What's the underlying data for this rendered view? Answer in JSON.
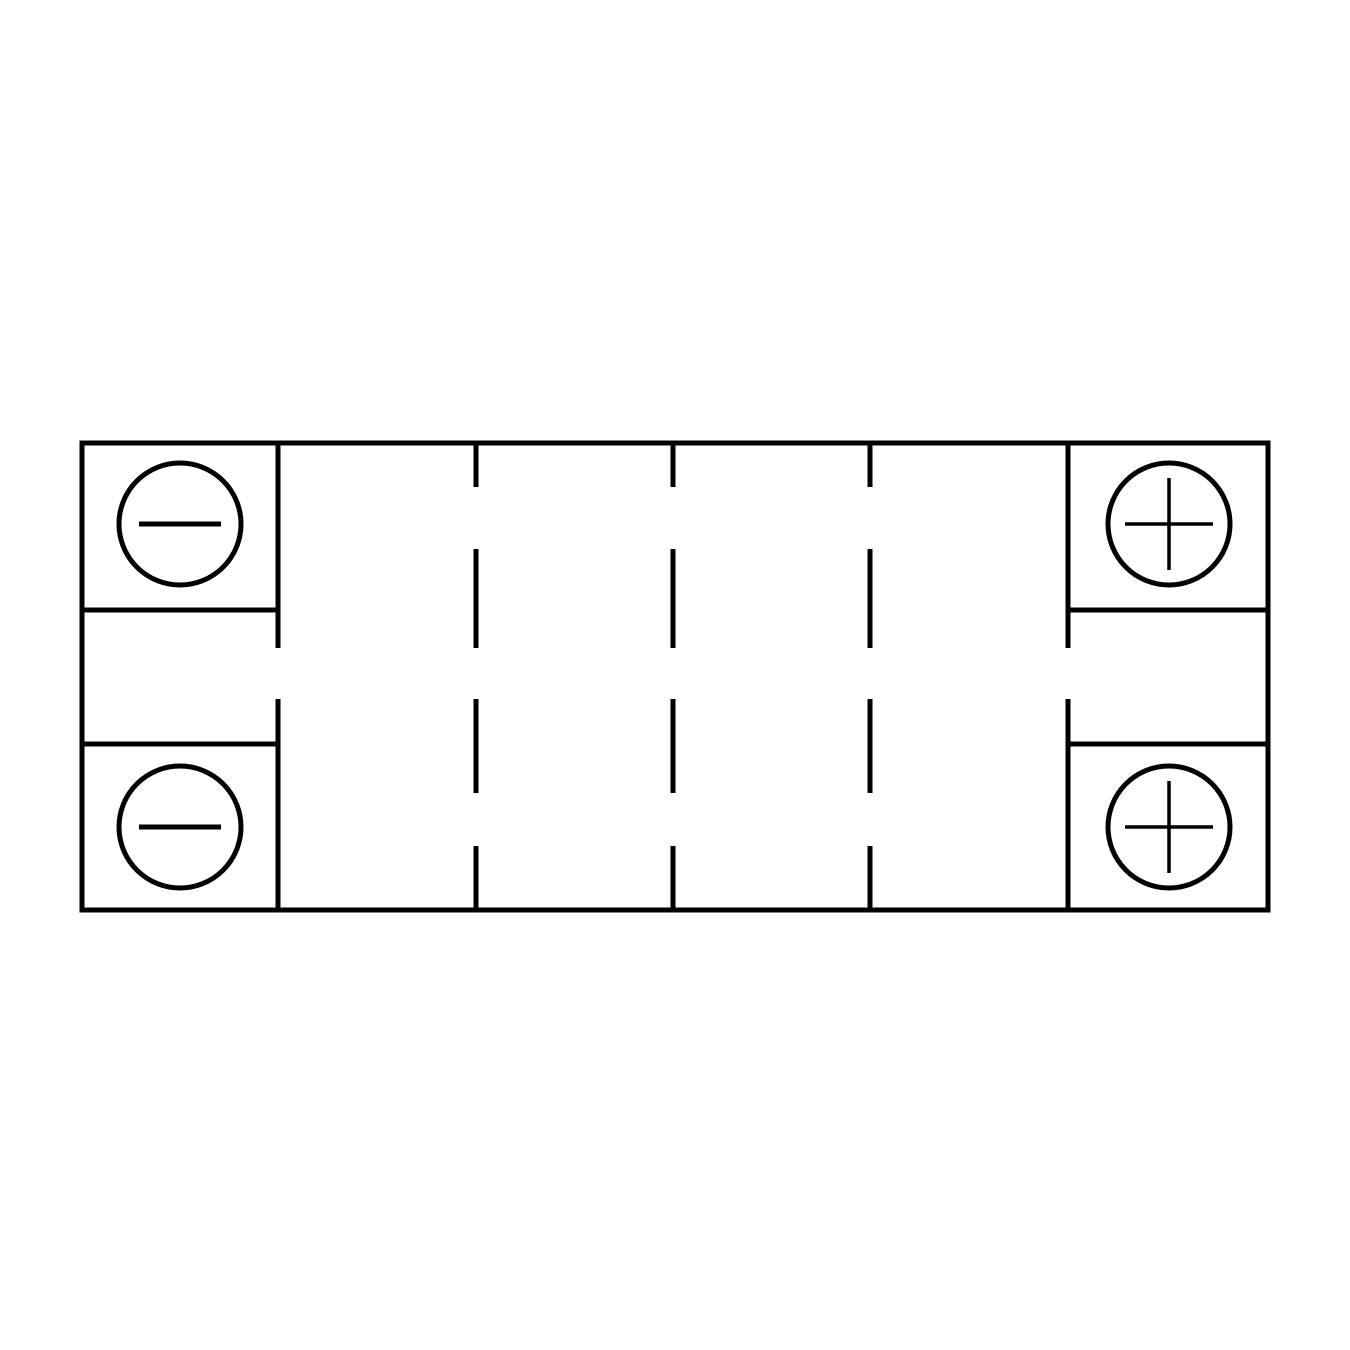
{
  "figure": {
    "type": "battery-top-view-diagram",
    "background": "#ffffff",
    "stroke_color": "#000000",
    "body": {
      "cell_count": 6,
      "divider_count": 5,
      "divider_style": "dashed"
    },
    "terminals": [
      {
        "position": "top-left",
        "polarity": "negative",
        "symbol": "−"
      },
      {
        "position": "top-right",
        "polarity": "positive",
        "symbol": "+"
      },
      {
        "position": "bottom-left",
        "polarity": "negative",
        "symbol": "−"
      },
      {
        "position": "bottom-right",
        "polarity": "positive",
        "symbol": "+"
      }
    ]
  }
}
